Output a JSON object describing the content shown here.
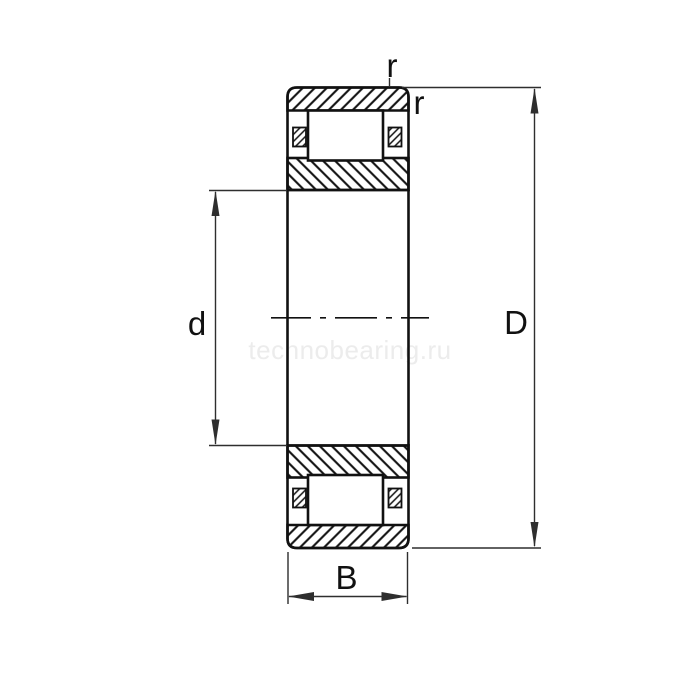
{
  "drawing": {
    "watermark": "technobearing.ru",
    "labels": {
      "bore_diameter": "d",
      "outer_diameter": "D",
      "width": "B",
      "radius_top": "r",
      "radius_side": "r"
    },
    "colors": {
      "line": "#111111",
      "dimension": "#2e2e2e",
      "watermark": "#ececec",
      "background": "#ffffff"
    }
  }
}
